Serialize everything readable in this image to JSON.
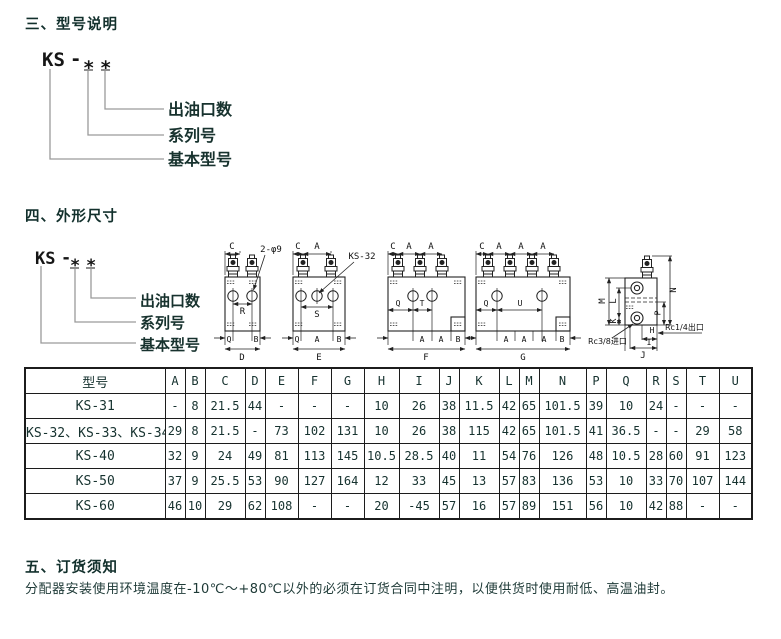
{
  "sections": {
    "model_designation": {
      "title": "三、型号说明"
    },
    "dimensions": {
      "title": "四、外形尺寸"
    },
    "ordering": {
      "title": "五、订货须知",
      "body": "分配器安装使用环境温度在-10℃～+80℃以外的必须在订货合同中注明，以便供货时使用耐低、高温油封。"
    }
  },
  "designation": {
    "prefix": "KS",
    "dash": "-",
    "star": "*",
    "outlet_label": "出油口数",
    "series_label": "系列号",
    "base_label": "基本型号"
  },
  "drawings": {
    "dims": {
      "A": "A",
      "B": "B",
      "C": "C",
      "D": "D",
      "E": "E",
      "F": "F",
      "G": "G",
      "H": "H",
      "I": "I",
      "J": "J",
      "K": "K",
      "L": "L",
      "M": "M",
      "N": "N",
      "P": "P",
      "Q": "Q",
      "R": "R",
      "S": "S",
      "T": "T",
      "U": "U"
    },
    "callout_holes": "2-φ9",
    "callout_model": "KS-32",
    "inlet_port": "Rc3/8进口",
    "outlet_port": "Rc1/4出口"
  },
  "table": {
    "columns": [
      "型号",
      "A",
      "B",
      "C",
      "D",
      "E",
      "F",
      "G",
      "H",
      "I",
      "J",
      "K",
      "L",
      "M",
      "N",
      "P",
      "Q",
      "R",
      "S",
      "T",
      "U"
    ],
    "rows": [
      [
        "KS-31",
        "-",
        "8",
        "21.5",
        "44",
        "-",
        "-",
        "-",
        "10",
        "26",
        "38",
        "11.5",
        "42",
        "65",
        "101.5",
        "39",
        "10",
        "24",
        "-",
        "-",
        "-"
      ],
      [
        "KS-32、KS-33、KS-34",
        "29",
        "8",
        "21.5",
        "-",
        "73",
        "102",
        "131",
        "10",
        "26",
        "38",
        "115",
        "42",
        "65",
        "101.5",
        "41",
        "36.5",
        "-",
        "-",
        "29",
        "58"
      ],
      [
        "KS-40",
        "32",
        "9",
        "24",
        "49",
        "81",
        "113",
        "145",
        "10.5",
        "28.5",
        "40",
        "11",
        "54",
        "76",
        "126",
        "48",
        "10.5",
        "28",
        "60",
        "91",
        "123"
      ],
      [
        "KS-50",
        "37",
        "9",
        "25.5",
        "53",
        "90",
        "127",
        "164",
        "12",
        "33",
        "45",
        "13",
        "57",
        "83",
        "136",
        "53",
        "10",
        "33",
        "70",
        "107",
        "144"
      ],
      [
        "KS-60",
        "46",
        "10",
        "29",
        "62",
        "108",
        "-",
        "-",
        "20",
        "-45",
        "57",
        "16",
        "57",
        "89",
        "151",
        "56",
        "10",
        "42",
        "88",
        "-",
        "-"
      ]
    ]
  }
}
